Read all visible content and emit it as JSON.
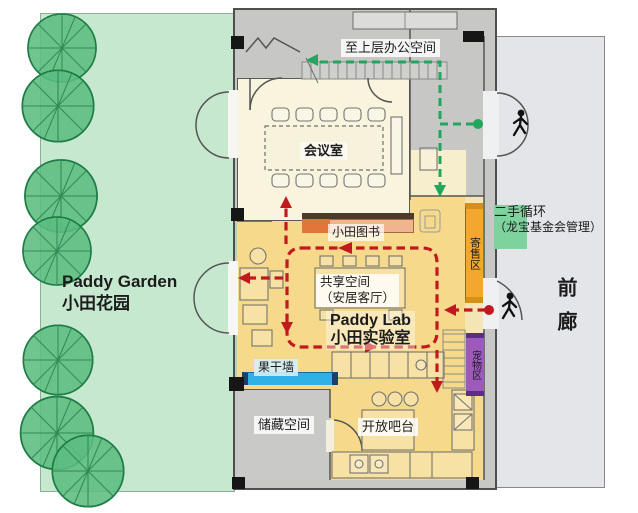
{
  "colors": {
    "garden_green": "#c6e8cf",
    "tree_green": "#5cbd80",
    "tree_outline": "#1e7c46",
    "lab_yellow": "#f6d98b",
    "cream": "#f8f4de",
    "pale_band": "#f3e6b4",
    "wall_gray": "#c7c7c5",
    "storage_gray": "#c9c9c7",
    "porch_gray": "#e3e5e8",
    "orange_strip": "#f3a72f",
    "purple_strip": "#9e59bd",
    "blue_strip": "#2fb1e5",
    "navy_cap": "#1d3f6b",
    "bookshelf_peach": "#f0b48e",
    "bookshelf_accent": "#e0763a",
    "secondhand_green": "#7ed29d",
    "route_red": "#c2191f",
    "route_green": "#23a65e"
  },
  "garden": {
    "name_en": "Paddy Garden",
    "name_zh": "小田花园"
  },
  "plan": {
    "upper_route": "至上层办公空间",
    "meeting_room": "会议室",
    "library": "小田图书",
    "consignment": "寄售区",
    "secondhand_line1": "二手循环",
    "secondhand_line2": "（龙宝基金会管理）",
    "shared_line1": "共享空间",
    "shared_line2": "（安居客厅）",
    "lab_en": "Paddy Lab",
    "lab_zh": "小田实验室",
    "fruit_wall": "果干墙",
    "storage": "储藏空间",
    "bar": "开放吧台",
    "pets": "宠物区",
    "porch": "前廊"
  }
}
